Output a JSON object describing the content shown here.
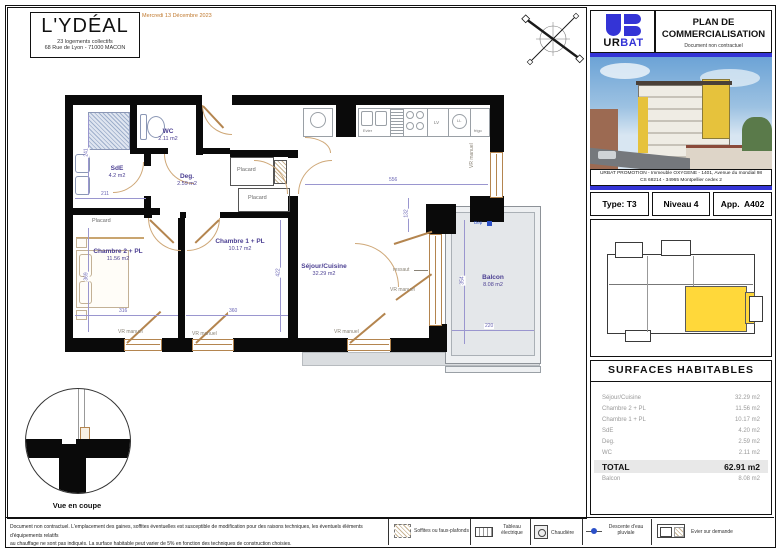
{
  "header": {
    "title": "L'YDÉAL",
    "subtitle1": "23 logements collectifs",
    "subtitle2": "68 Rue de Lyon - 71000 MACON",
    "date": "Mercredi 13 Décembre 2023"
  },
  "brand": {
    "ur": "UR",
    "bat": "BAT",
    "plan_line1": "PLAN DE",
    "plan_line2": "COMMERCIALISATION",
    "note": "Document non contractuel",
    "brand_blue": "#3434d6"
  },
  "photo": {
    "caption1": "URBAT PROMOTION - Immeuble OXYGENE - 1401, Avenue du mondial 98",
    "caption2": "CS 68214  -  34965 Montpellier cedex 2"
  },
  "unit": {
    "type": "Type: T3",
    "level": "Niveau 4",
    "app": "App.  A402"
  },
  "surfaces": {
    "title": "SURFACES HABITABLES",
    "rows": [
      {
        "label": "Séjour/Cuisine",
        "value": "32.29 m2"
      },
      {
        "label": "Chambre 2 + PL",
        "value": "11.56 m2"
      },
      {
        "label": "Chambre 1 + PL",
        "value": "10.17 m2"
      },
      {
        "label": "SdE",
        "value": "4.20 m2"
      },
      {
        "label": "Deg.",
        "value": "2.59 m2"
      },
      {
        "label": "WC",
        "value": "2.11 m2"
      }
    ],
    "total": {
      "label": "TOTAL",
      "value": "62.91 m2"
    },
    "balcony": {
      "label": "Balcon",
      "value": "8.08 m2"
    }
  },
  "plan": {
    "rooms": {
      "wc": {
        "name": "WC",
        "area": "2.11 m2"
      },
      "sde": {
        "name": "SdE",
        "area": "4.2 m2"
      },
      "deg": {
        "name": "Deg.",
        "area": "2.59 m2"
      },
      "ch2": {
        "name": "Chambre 2 + PL",
        "area": "11.56 m2"
      },
      "ch1": {
        "name": "Chambre 1 + PL",
        "area": "10.17 m2"
      },
      "sejour": {
        "name": "Séjour/Cuisine",
        "area": "32.29 m2"
      },
      "balcon": {
        "name": "Balcon",
        "area": "8.08 m2"
      }
    },
    "placard": "Placard",
    "vr": "VR manuel",
    "ressaut": "ressaut",
    "dep": "Dep",
    "kitchen": {
      "evier": "Evier",
      "lv": "LV",
      "ll": "LL",
      "frigo": "frigo"
    },
    "dims": {
      "sde_w": "211",
      "sde_h": "241",
      "ch2_w": "316",
      "ch2_h": "369",
      "ch1_w": "360",
      "ch1_h": "422",
      "sejour_w": "556",
      "jog_h": "132",
      "balcon_h": "354",
      "balcon_w": "220"
    },
    "accent_yellow": "#ffd83a",
    "room_purple": "#4b3f92",
    "dim_blue": "#6b66b5",
    "door_tan": "#b4854f"
  },
  "section": {
    "caption": "Vue en coupe"
  },
  "footer": {
    "line1": "Document non contractuel. L'emplacement des gaines, soffites éventuelles est susceptible de modification pour des raisons techniques, les éventuels éléments d'équipements relatifs",
    "line2": "au chauffage ne sont pas indiqués. La surface habitable peut varier de 5% en fonction des techniques de construction choisies.",
    "legend": [
      {
        "label": "Soffites ou faux-plafonds"
      },
      {
        "label": "Tableau électrique"
      },
      {
        "label": "Chaudière"
      },
      {
        "label": "Descente d'eau pluviale"
      },
      {
        "label": "Evier sur demande"
      }
    ]
  }
}
